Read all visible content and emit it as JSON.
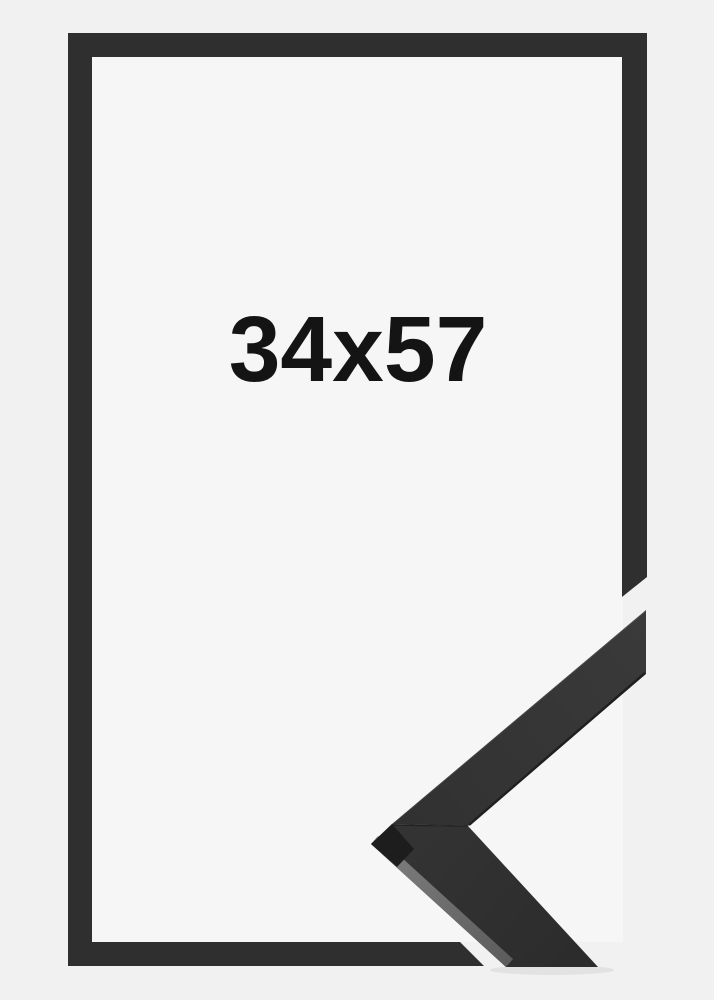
{
  "frame_preview": {
    "size_label": "34x57"
  },
  "colors": {
    "page_background": "#f1f1f1",
    "frame_interior": "#f6f6f6",
    "frame_color": "#2f2f2f",
    "label_text": "#141414",
    "moulding_top_face": "#3a3a3a",
    "moulding_front_face": "#333333",
    "moulding_bevel_highlight": "#5c5c5c",
    "moulding_tip_shadow": "#1d1d1d",
    "moulding_edge_dark": "#1f1f1f"
  }
}
